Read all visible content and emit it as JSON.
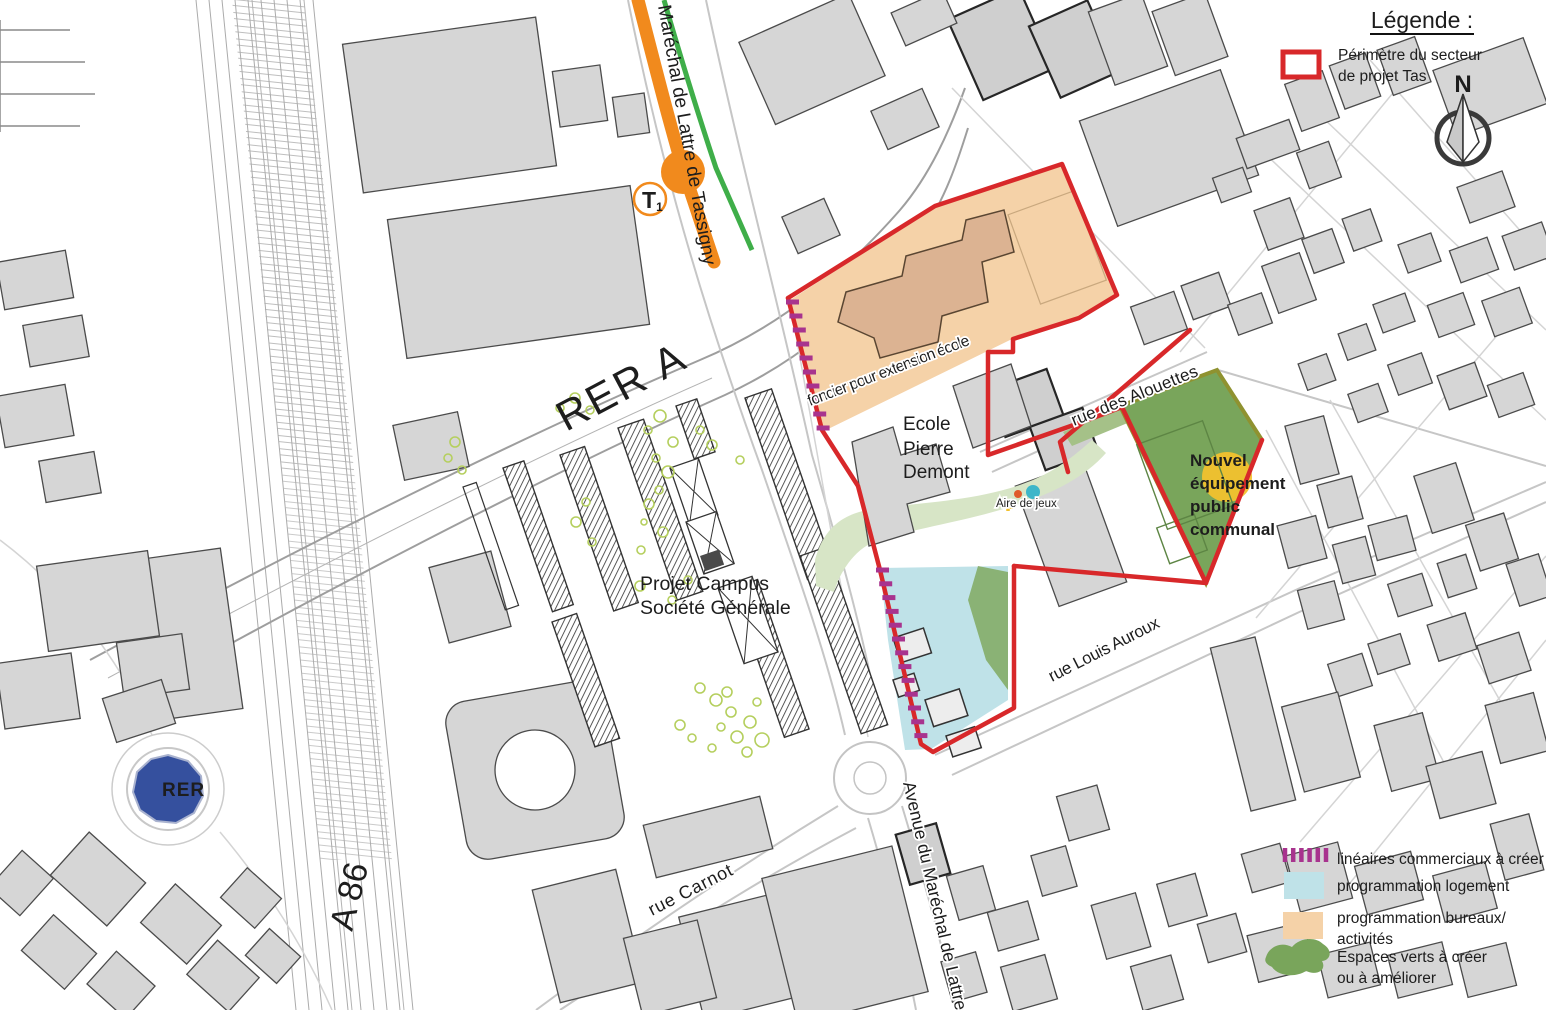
{
  "legend": {
    "title": "Légende :",
    "perimeter": {
      "line1": "Périmètre du secteur",
      "line2": "de projet Tas"
    },
    "items": [
      {
        "label": "linéaires commerciaux à créer"
      },
      {
        "label": "programmation logement"
      },
      {
        "line1": "programmation bureaux/",
        "line2": "activités"
      },
      {
        "line1": "Espaces verts à créer",
        "line2": "ou à améliorer"
      }
    ],
    "compass": "N"
  },
  "map": {
    "transit": {
      "tram_badge": "T",
      "tram_badge_number": "1",
      "rer_marker": "RER"
    },
    "labels": {
      "rer_a": "RER A",
      "a86": "A 86",
      "marechal_top": "Maréchal de Lattre de Tassigny",
      "avenue_marechal": "Avenue du Maréchal de Lattre de",
      "rue_carnot": "rue Carnot",
      "rue_des_alouettes": "rue des Alouettes",
      "rue_louis_auroux": "rue Louis Auroux",
      "foncier": "foncier pour extension école",
      "ecole_line1": "Ecole",
      "ecole_line2": "Pierre",
      "ecole_line3": "Demont",
      "campus_line1": "Projet  Campus",
      "campus_line2": "Société Générale",
      "aire_de_jeux": "Aire de jeux",
      "equipement_line1": "Nouvel",
      "equipement_line2": "équipement",
      "equipement_line3": "public",
      "equipement_line4": "communal"
    }
  },
  "colors": {
    "perimeter_red": "#d8282a",
    "commercial_purple": "#a8338e",
    "logement_blue": "#bfe2e8",
    "bureaux_orange": "#f5d2a8",
    "bureaux_building": "#dcb392",
    "espaces_verts": "#79a55b",
    "espaces_verts_light": "#d7e5c6",
    "equipement_border_olive": "#8f9230",
    "equipement_highlight_yellow": "#f2c12e",
    "tram_orange": "#f18a1d",
    "tram_parallel_green": "#3fae49",
    "rer_blue": "#35509e",
    "building_gray": "#d6d6d6"
  }
}
